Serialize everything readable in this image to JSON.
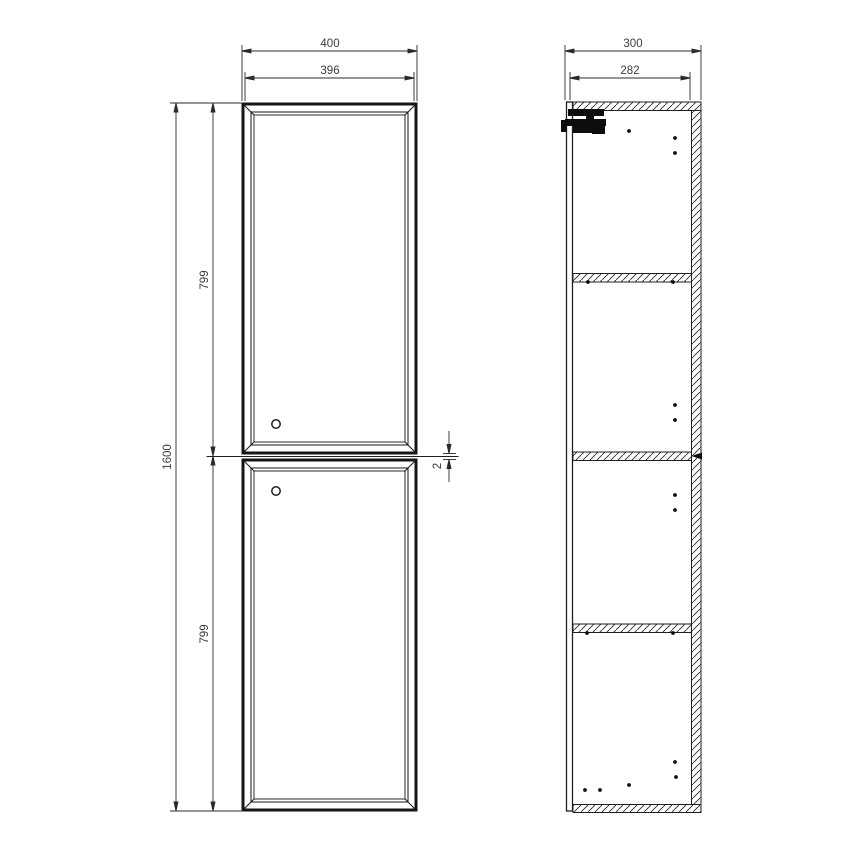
{
  "page": {
    "background": "#ffffff",
    "description": "Technical dimensional drawing of a tall two-door wall cabinet: front elevation (left) and side section (right)"
  },
  "drawing": {
    "line_color": "#1f1f1f",
    "dim_line_color": "#2b2b2b",
    "text_color": "#3c3c3c",
    "front_view": {
      "dim_width_overall": "400",
      "dim_width_door": "396",
      "dim_height_overall": "1600",
      "dim_door_top_height": "799",
      "dim_door_bottom_height": "799",
      "dim_door_gap": "2"
    },
    "side_view": {
      "dim_depth_overall": "300",
      "dim_depth_internal": "282"
    }
  }
}
